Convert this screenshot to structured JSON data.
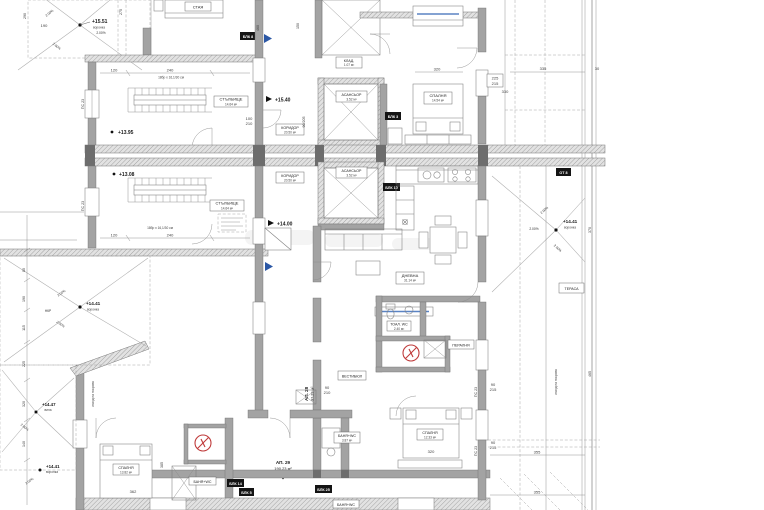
{
  "colors": {
    "wall_gray": "#a3a3a3",
    "hatch_gray": "#e2e2e2",
    "boiler_red": "#bf3a3a",
    "marker_blue": "#2b57a5"
  },
  "t": {
    "lvl_1551": "+15.51",
    "lvl_1540": "+15.40",
    "lvl_1395": "+13.95",
    "lvl_1400": "+14.00",
    "lvl_1308": "+13.08",
    "lvl_1441": "+14.41",
    "lvl_1447": "+14.47",
    "voronka": "воронка",
    "vila": "вила",
    "nkr": "НКР",
    "slope": "2.00%",
    "stair_name": "СТЪЛБИЩЕ",
    "stair_area": "14.64 м²",
    "cor_name": "КОРИДОР",
    "cor_area": "20.50 м²",
    "elev_name": "АСАНСЬОР",
    "elev_area": "3.52 м²",
    "bedroom": "СПАЛНЯ",
    "bed1_area": "14.54 м²",
    "bed2_area": "12.33 м²",
    "bed3_area": "13.82 м²",
    "living_name": "ДНЕВНА",
    "living_area": "31.14 м²",
    "wc_name": "ТОАЛ. WC",
    "wc_area": "2.40 м²",
    "bath_name": "БАНЯ+WC",
    "bath_area": "3.87 м²",
    "hall_name": "ВЕСТИБЮЛ",
    "laundry": "ПЕРАЛНЯ",
    "closet": "КЛАД.",
    "closet_area": "1.07 м²",
    "staya": "СТАЯ",
    "terrace": "ТЕРАСА",
    "ap28": "АП. 28",
    "ap28_area": "97.29 м²",
    "ap29": "АП. 29",
    "ap29_area": "190.23 м²",
    "blk8": "БЛК 8",
    "blk3": "БЛК 3",
    "blk10": "БЛК 10",
    "blk25": "БЛК 25",
    "blk14": "БЛК 14",
    "blk5": "БЛК 5",
    "ot8": "ОТ 8",
    "stair_note": "18бр x 16,1/30 см",
    "roof_exit": "изход на покрива",
    "ps23": "ПС 23",
    "d90205": "90/205",
    "d30": "30",
    "d80": "80",
    "d90": "90",
    "d100": "100",
    "d115": "115",
    "d120": "120",
    "d140": "140",
    "d150": "150",
    "d190": "190",
    "d210": "210",
    "d215": "215",
    "d225": "225",
    "d240": "240",
    "d275": "275",
    "d290": "290",
    "d320": "320",
    "d330": "330",
    "d335": "335",
    "d355": "355",
    "d362": "362",
    "d370": "370",
    "d385": "385",
    "d460": "460",
    "d465": "465"
  }
}
